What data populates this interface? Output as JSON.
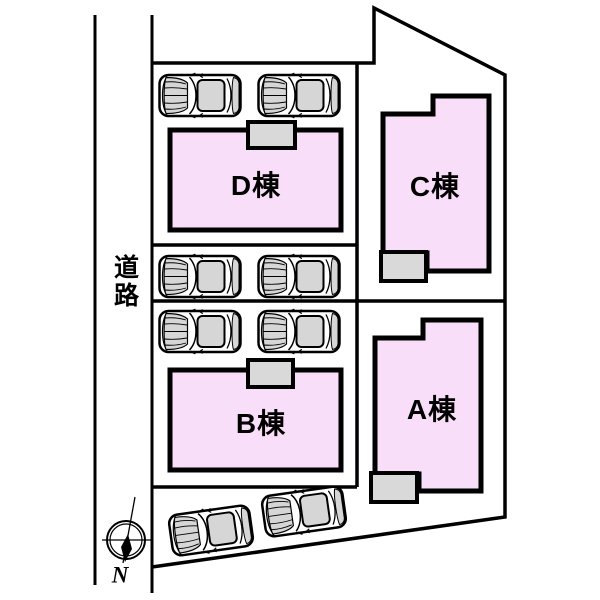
{
  "site_plan": {
    "road": {
      "label": "道路"
    },
    "compass": {
      "label": "N"
    },
    "buildings": {
      "a": {
        "label": "A棟"
      },
      "b": {
        "label": "B棟"
      },
      "c": {
        "label": "C棟"
      },
      "d": {
        "label": "D棟"
      }
    },
    "parking": {
      "car_count": 8
    },
    "colors": {
      "building_fill": "#F8DEF8",
      "porch_fill": "#D9D9D9",
      "car_shade": "#D6D6D6",
      "line": "#000000",
      "background": "#FFFFFF"
    }
  }
}
